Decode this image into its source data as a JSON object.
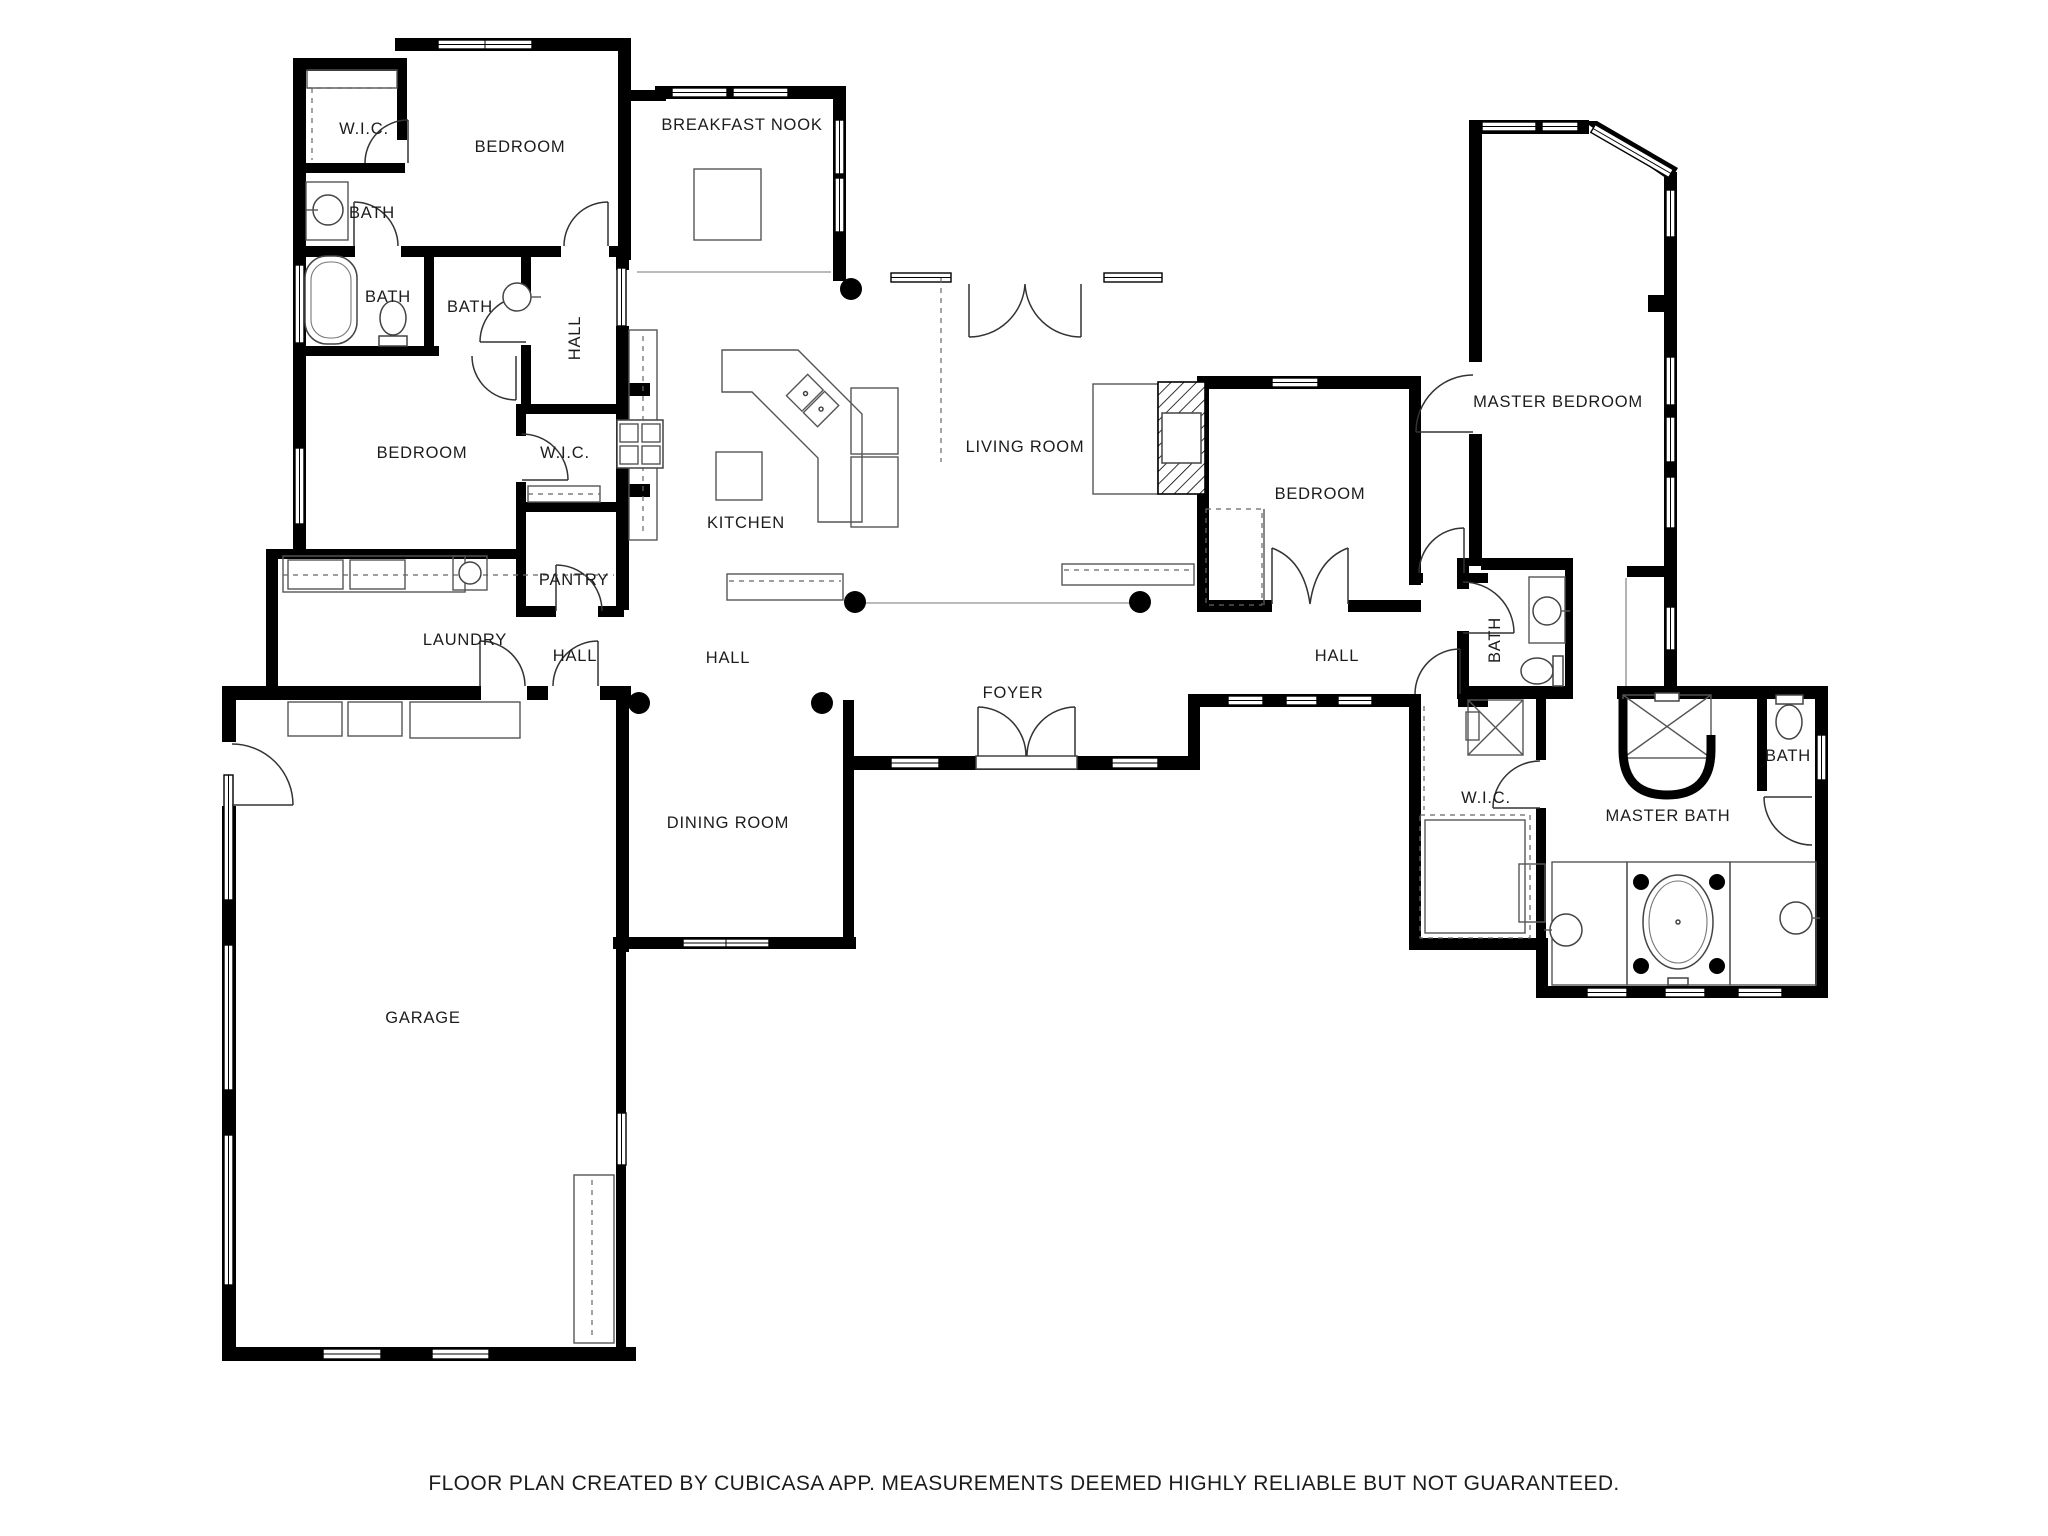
{
  "disclaimer": "FLOOR PLAN CREATED BY CUBICASA APP. MEASUREMENTS DEEMED HIGHLY RELIABLE BUT NOT GUARANTEED.",
  "colors": {
    "wall": "#000000",
    "background": "#ffffff",
    "fixture_line": "#555555"
  },
  "rooms": [
    {
      "id": "wic-1",
      "label": "W.I.C."
    },
    {
      "id": "bedroom-1",
      "label": "BEDROOM"
    },
    {
      "id": "breakfast-nook",
      "label": "BREAKFAST NOOK"
    },
    {
      "id": "bath-1",
      "label": "BATH"
    },
    {
      "id": "bath-2",
      "label": "BATH"
    },
    {
      "id": "bath-3",
      "label": "BATH"
    },
    {
      "id": "hall-1",
      "label": "HALL"
    },
    {
      "id": "bedroom-2",
      "label": "BEDROOM"
    },
    {
      "id": "wic-2",
      "label": "W.I.C."
    },
    {
      "id": "kitchen",
      "label": "KITCHEN"
    },
    {
      "id": "living-room",
      "label": "LIVING ROOM"
    },
    {
      "id": "bedroom-3",
      "label": "BEDROOM"
    },
    {
      "id": "master-bedroom",
      "label": "MASTER BEDROOM"
    },
    {
      "id": "pantry",
      "label": "PANTRY"
    },
    {
      "id": "laundry",
      "label": "LAUNDRY"
    },
    {
      "id": "hall-2",
      "label": "HALL"
    },
    {
      "id": "hall-3",
      "label": "HALL"
    },
    {
      "id": "foyer",
      "label": "FOYER"
    },
    {
      "id": "hall-4",
      "label": "HALL"
    },
    {
      "id": "bath-4",
      "label": "BATH"
    },
    {
      "id": "wic-3",
      "label": "W.I.C."
    },
    {
      "id": "master-bath",
      "label": "MASTER BATH"
    },
    {
      "id": "bath-5",
      "label": "BATH"
    },
    {
      "id": "garage",
      "label": "GARAGE"
    },
    {
      "id": "dining-room",
      "label": "DINING ROOM"
    }
  ]
}
